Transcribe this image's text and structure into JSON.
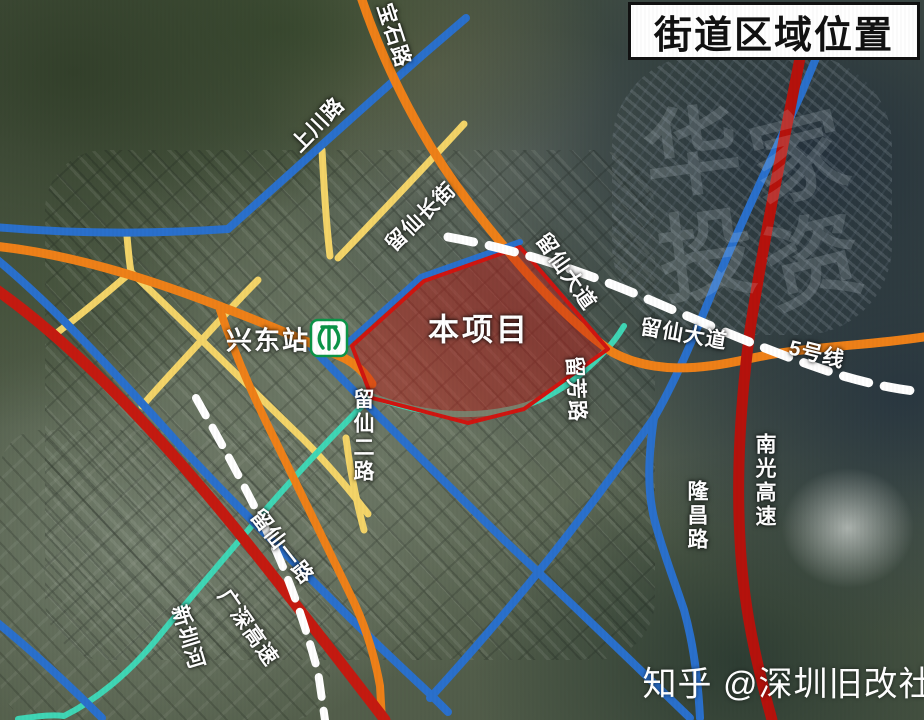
{
  "title": "街道区域位置",
  "project": {
    "label": "本项目",
    "fill_color": "#c31914",
    "border_color": "#d01510"
  },
  "station": {
    "name": "兴东站",
    "logo": "shenzhen-metro-logo",
    "logo_color": "#0b9447"
  },
  "road_labels": {
    "baoshi_rd": "宝石路",
    "shangchuan_rd": "上川路",
    "liuxian_changjie": "留仙长街",
    "liuxian_ave_1": "留仙大道",
    "liuxian_ave_2": "留仙大道",
    "metro_line5": "5号线",
    "nanguang_expwy": "南光高速",
    "longchang_rd": "隆昌路",
    "liufang_rd": "留芳路",
    "liuxian_2nd_rd": "留仙二路",
    "liuxian_1st_rd": "留仙一路",
    "guangshen_expwy": "广深高速",
    "xinzhen_river": "新圳河"
  },
  "road_colors": {
    "expressway_red": "#c41a10",
    "expressway_dark_red": "#b5120c",
    "arterial_orange": "#ee8018",
    "secondary_blue": "#2a70cc",
    "local_yellow": "#f3d468",
    "river_teal": "#3fd6b5",
    "metro_dash_white": "#ffffff"
  },
  "watermark": {
    "zhihu": "知乎 @深圳旧改社",
    "faint_chars": [
      "华",
      "家",
      "投",
      "资"
    ]
  }
}
